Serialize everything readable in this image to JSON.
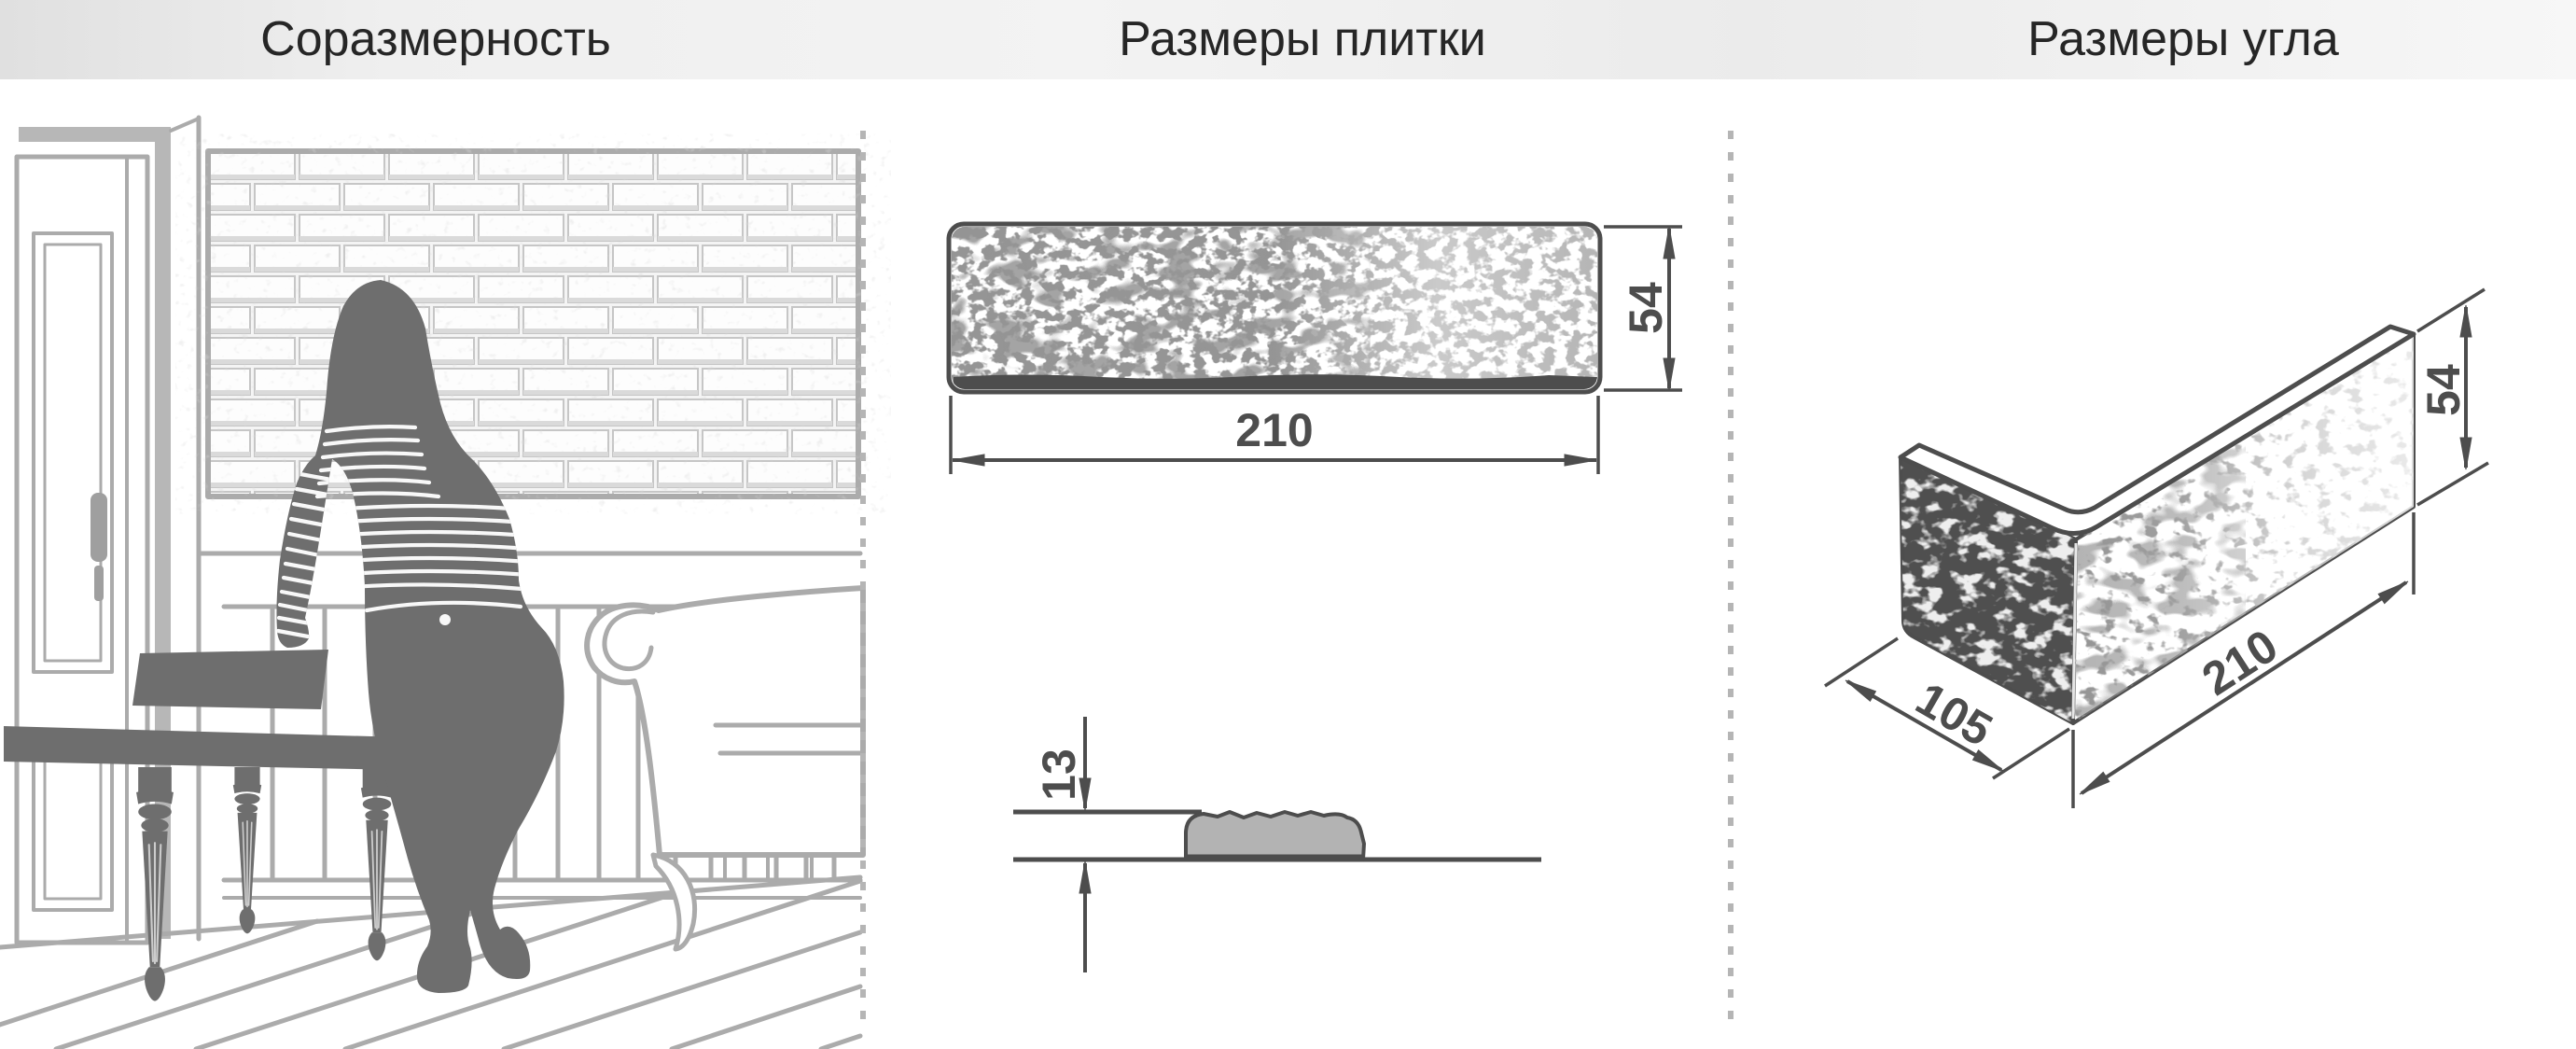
{
  "header": {
    "sections": [
      {
        "id": "proportionality",
        "label": "Соразмерность"
      },
      {
        "id": "tile-sizes",
        "label": "Размеры плитки"
      },
      {
        "id": "corner-sizes",
        "label": "Размеры угла"
      }
    ]
  },
  "tile": {
    "length_mm": "210",
    "height_mm": "54",
    "thickness_mm": "13"
  },
  "corner": {
    "short_side_mm": "105",
    "long_side_mm": "210",
    "height_mm": "54"
  },
  "colors": {
    "dimension_ink": "#4d4d4d",
    "line_art": "#ababab",
    "silhouette": "#6e6e6e",
    "profile_fill": "#b3b3b3",
    "separator_dots": "#b5b5b5",
    "header_text": "#262626",
    "background": "#ffffff"
  }
}
